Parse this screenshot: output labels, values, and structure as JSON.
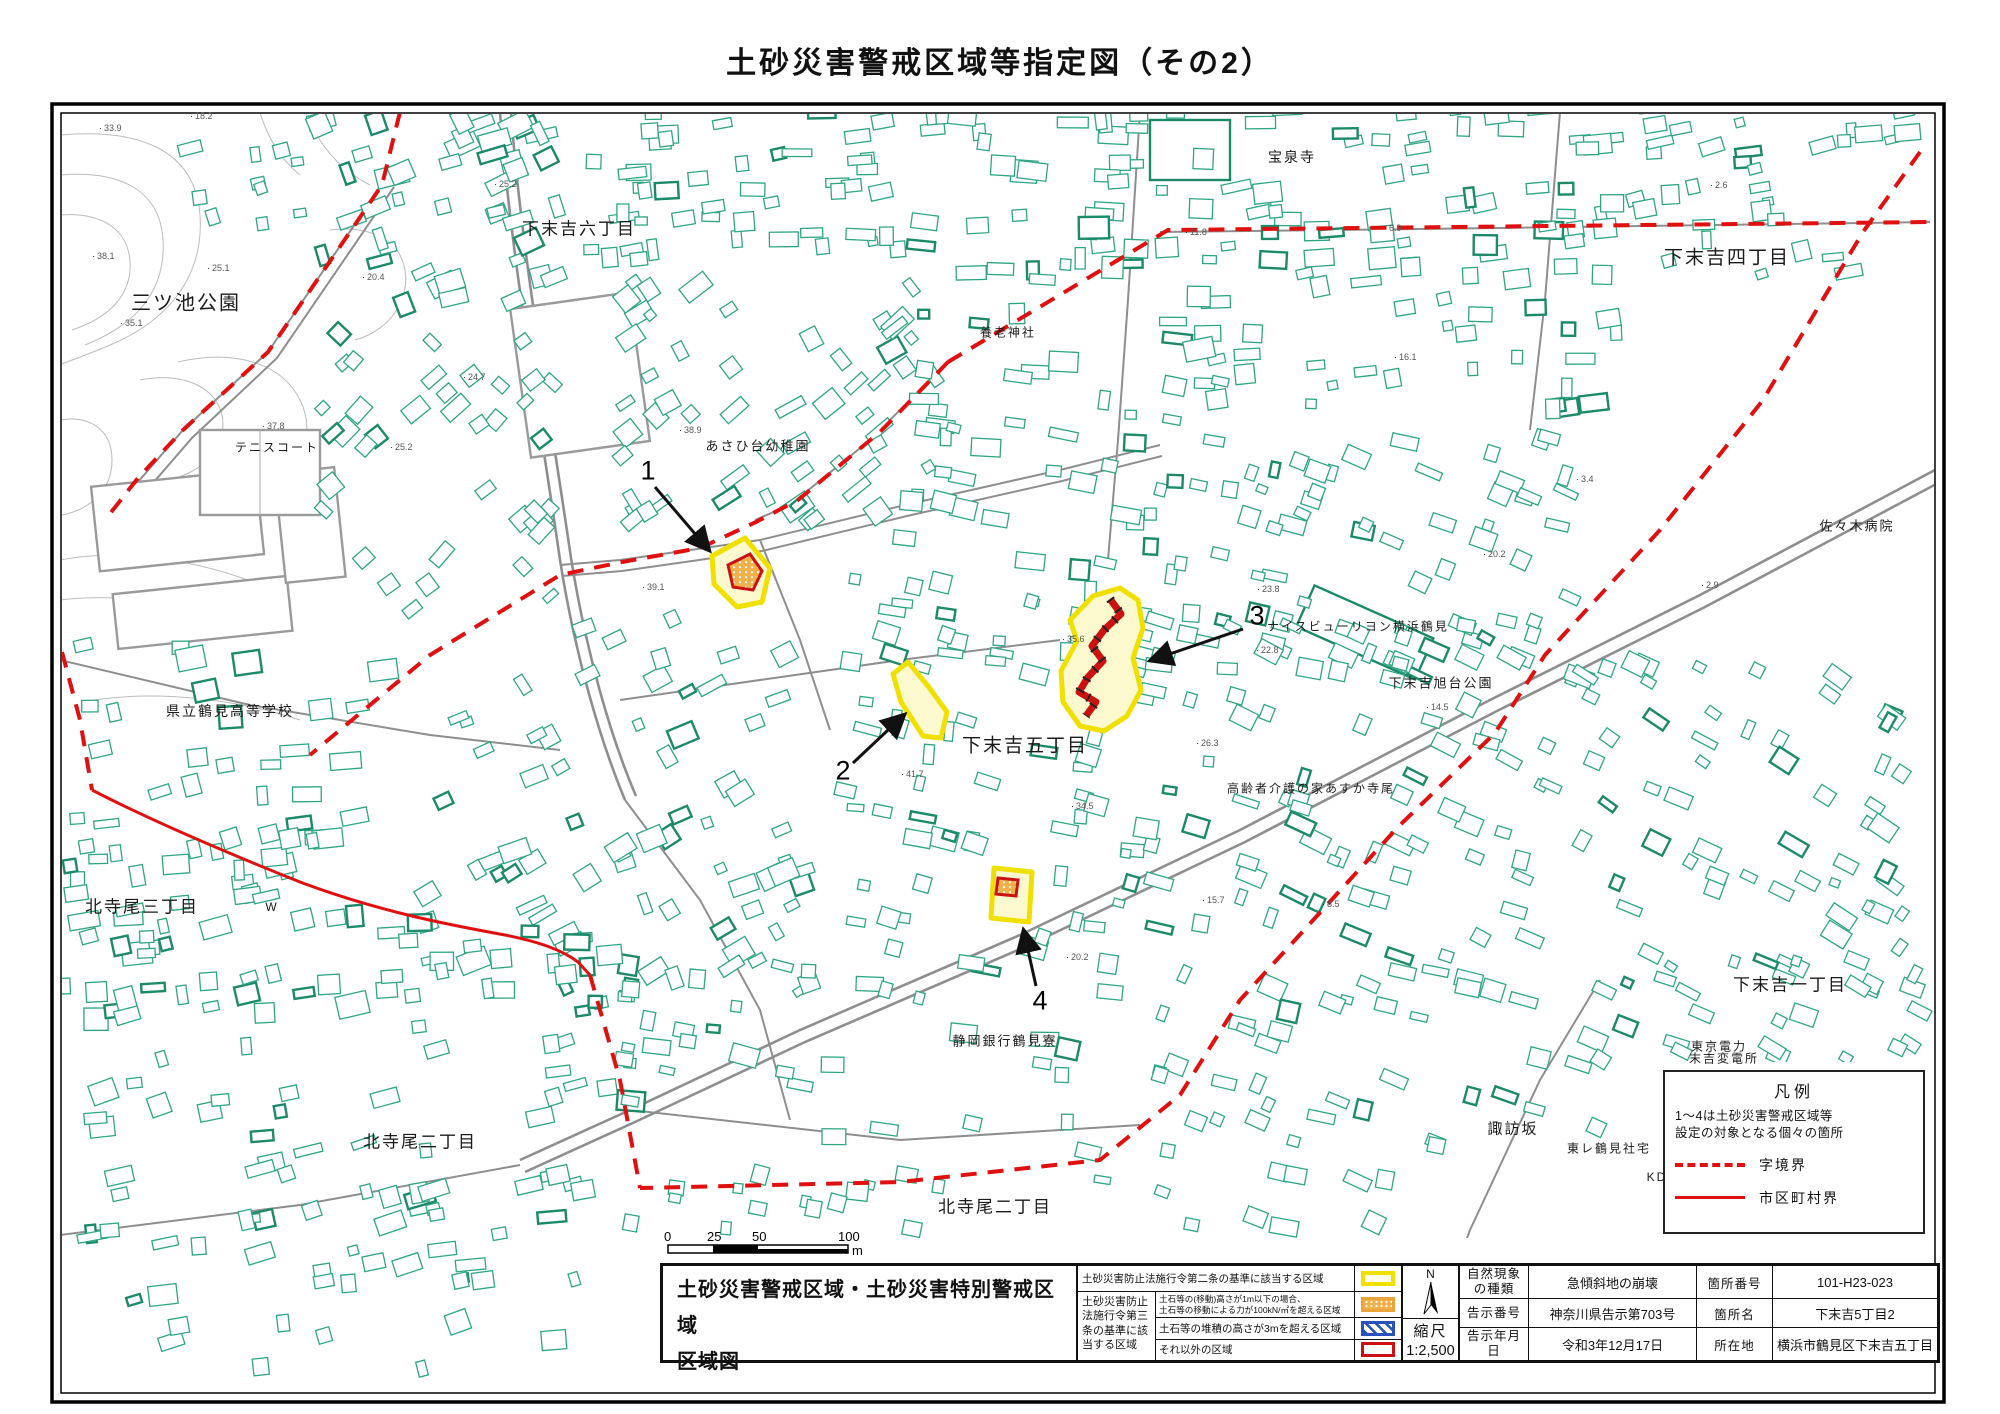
{
  "page_title": "土砂災害警戒区域等指定図（その2）",
  "colors": {
    "boundary_red": "#e01010",
    "special_red": "#cc1111",
    "zone_yellow": "#f0e000",
    "zone_fill": "#fdf9cf",
    "orange": "#e9a43c",
    "blue": "#2a52be",
    "building": "#2fa583",
    "building_dark": "#1c8a68",
    "road_gray": "#8e8e8e",
    "contour_gray": "#bcbcbc"
  },
  "map": {
    "labels": [
      {
        "t": "三ツ池公園",
        "x": 186,
        "y": 301,
        "size": 20
      },
      {
        "t": "下末吉六丁目",
        "x": 579,
        "y": 227,
        "size": 17
      },
      {
        "t": "テニスコート",
        "x": 277,
        "y": 447,
        "size": 12
      },
      {
        "t": "あさひ台幼稚園",
        "x": 758,
        "y": 445,
        "size": 13
      },
      {
        "t": "宝泉寺",
        "x": 1292,
        "y": 157,
        "size": 14
      },
      {
        "t": "下末吉四丁目",
        "x": 1727,
        "y": 256,
        "size": 19
      },
      {
        "t": "養老神社",
        "x": 1008,
        "y": 332,
        "size": 12
      },
      {
        "t": "県立鶴見高等学校",
        "x": 230,
        "y": 711,
        "size": 14
      },
      {
        "t": "下末吉五丁目",
        "x": 1025,
        "y": 744,
        "size": 19
      },
      {
        "t": "ナイスビューリヨン横浜鶴見",
        "x": 1358,
        "y": 626,
        "size": 12
      },
      {
        "t": "下末吉旭台公園",
        "x": 1441,
        "y": 682,
        "size": 13
      },
      {
        "t": "高齢者介護の家あすか寺尾",
        "x": 1311,
        "y": 788,
        "size": 12
      },
      {
        "t": "佐々木病院",
        "x": 1857,
        "y": 525,
        "size": 13
      },
      {
        "t": "北寺尾三丁目",
        "x": 142,
        "y": 905,
        "size": 17
      },
      {
        "t": "W",
        "x": 272,
        "y": 907,
        "size": 12
      },
      {
        "t": "北寺尾二丁目",
        "x": 420,
        "y": 1140,
        "size": 17
      },
      {
        "t": "北寺尾二丁目",
        "x": 995,
        "y": 1205,
        "size": 17
      },
      {
        "t": "下末吉一丁目",
        "x": 1790,
        "y": 983,
        "size": 17
      },
      {
        "t": "諏訪坂",
        "x": 1513,
        "y": 1128,
        "size": 15
      },
      {
        "t": "静岡銀行鶴見寮",
        "x": 1005,
        "y": 1040,
        "size": 13
      },
      {
        "t": "東京電力",
        "x": 1719,
        "y": 1046,
        "size": 12
      },
      {
        "t": "末吉変電所",
        "x": 1724,
        "y": 1058,
        "size": 12
      },
      {
        "t": "東レ鶴見社宅",
        "x": 1609,
        "y": 1148,
        "size": 12
      },
      {
        "t": "KD",
        "x": 1657,
        "y": 1177,
        "size": 12
      }
    ],
    "elevations": [
      {
        "v": "33.9",
        "x": 99,
        "y": 128
      },
      {
        "v": "18.2",
        "x": 190,
        "y": 116
      },
      {
        "v": "38.1",
        "x": 92,
        "y": 256
      },
      {
        "v": "25.1",
        "x": 207,
        "y": 268
      },
      {
        "v": "20.4",
        "x": 362,
        "y": 277
      },
      {
        "v": "25.2",
        "x": 494,
        "y": 184
      },
      {
        "v": "35.1",
        "x": 120,
        "y": 323
      },
      {
        "v": "37.8",
        "x": 262,
        "y": 426
      },
      {
        "v": "24.7",
        "x": 463,
        "y": 377
      },
      {
        "v": "25.2",
        "x": 390,
        "y": 447
      },
      {
        "v": "38.9",
        "x": 679,
        "y": 430
      },
      {
        "v": "39.1",
        "x": 642,
        "y": 587
      },
      {
        "v": "41.7",
        "x": 901,
        "y": 774
      },
      {
        "v": "35.6",
        "x": 1062,
        "y": 639
      },
      {
        "v": "34.5",
        "x": 1071,
        "y": 806
      },
      {
        "v": "23.8",
        "x": 1257,
        "y": 589
      },
      {
        "v": "22.8",
        "x": 1256,
        "y": 650
      },
      {
        "v": "26.3",
        "x": 1196,
        "y": 743
      },
      {
        "v": "11.8",
        "x": 1185,
        "y": 232
      },
      {
        "v": "6.9",
        "x": 1384,
        "y": 228
      },
      {
        "v": "16.1",
        "x": 1394,
        "y": 357
      },
      {
        "v": "2.6",
        "x": 1710,
        "y": 185
      },
      {
        "v": "3.4",
        "x": 1576,
        "y": 479
      },
      {
        "v": "20.2",
        "x": 1483,
        "y": 554
      },
      {
        "v": "2.9",
        "x": 1701,
        "y": 585
      },
      {
        "v": "14.5",
        "x": 1426,
        "y": 707
      },
      {
        "v": "8.5",
        "x": 1322,
        "y": 904
      },
      {
        "v": "20.2",
        "x": 1066,
        "y": 957
      },
      {
        "v": "15.7",
        "x": 1202,
        "y": 900
      }
    ],
    "zones": [
      {
        "n": "1",
        "x": 648,
        "y": 471
      },
      {
        "n": "2",
        "x": 843,
        "y": 771
      },
      {
        "n": "3",
        "x": 1257,
        "y": 616
      },
      {
        "n": "4",
        "x": 1040,
        "y": 1001
      }
    ],
    "legend_box": {
      "title": "凡例",
      "note_line1": "1～4は土砂災害警戒区域等",
      "note_line2": "設定の対象となる個々の箇所",
      "dashed_label": "字境界",
      "solid_label": "市区町村界"
    }
  },
  "scalebar": {
    "t0": "0",
    "t25": "25",
    "t50": "50",
    "t100": "100",
    "unit": "m"
  },
  "title_block": {
    "main_title_line1": "土砂災害警戒区域・土砂災害特別警戒区域",
    "main_title_line2": "区域図",
    "legend": {
      "row1": "土砂災害防止法施行令第二条の基準に該当する区域",
      "group_label": "土砂災害防止法施行令第三条の基準に該当する区域",
      "row2_line1": "土石等の(移動)高さが1m以下の場合、",
      "row2_line2": "土石等の移動による力が100kN/㎡を超える区域",
      "row3": "土石等の堆積の高さが3mを超える区域",
      "row4": "それ以外の区域"
    },
    "north_label": "N",
    "scale_label": "縮尺",
    "scale_value": "1:2,500",
    "info": {
      "rows": [
        {
          "label": "自然現象\nの種類",
          "value": "急傾斜地の崩壊",
          "label2": "箇所番号",
          "value2": "101-H23-023"
        },
        {
          "label": "告示番号",
          "value": "神奈川県告示第703号",
          "label2": "箇所名",
          "value2": "下末吉5丁目2"
        },
        {
          "label": "告示年月日",
          "value": "令和3年12月17日",
          "label2": "所在地",
          "value2": "横浜市鶴見区下末吉五丁目"
        }
      ]
    }
  }
}
